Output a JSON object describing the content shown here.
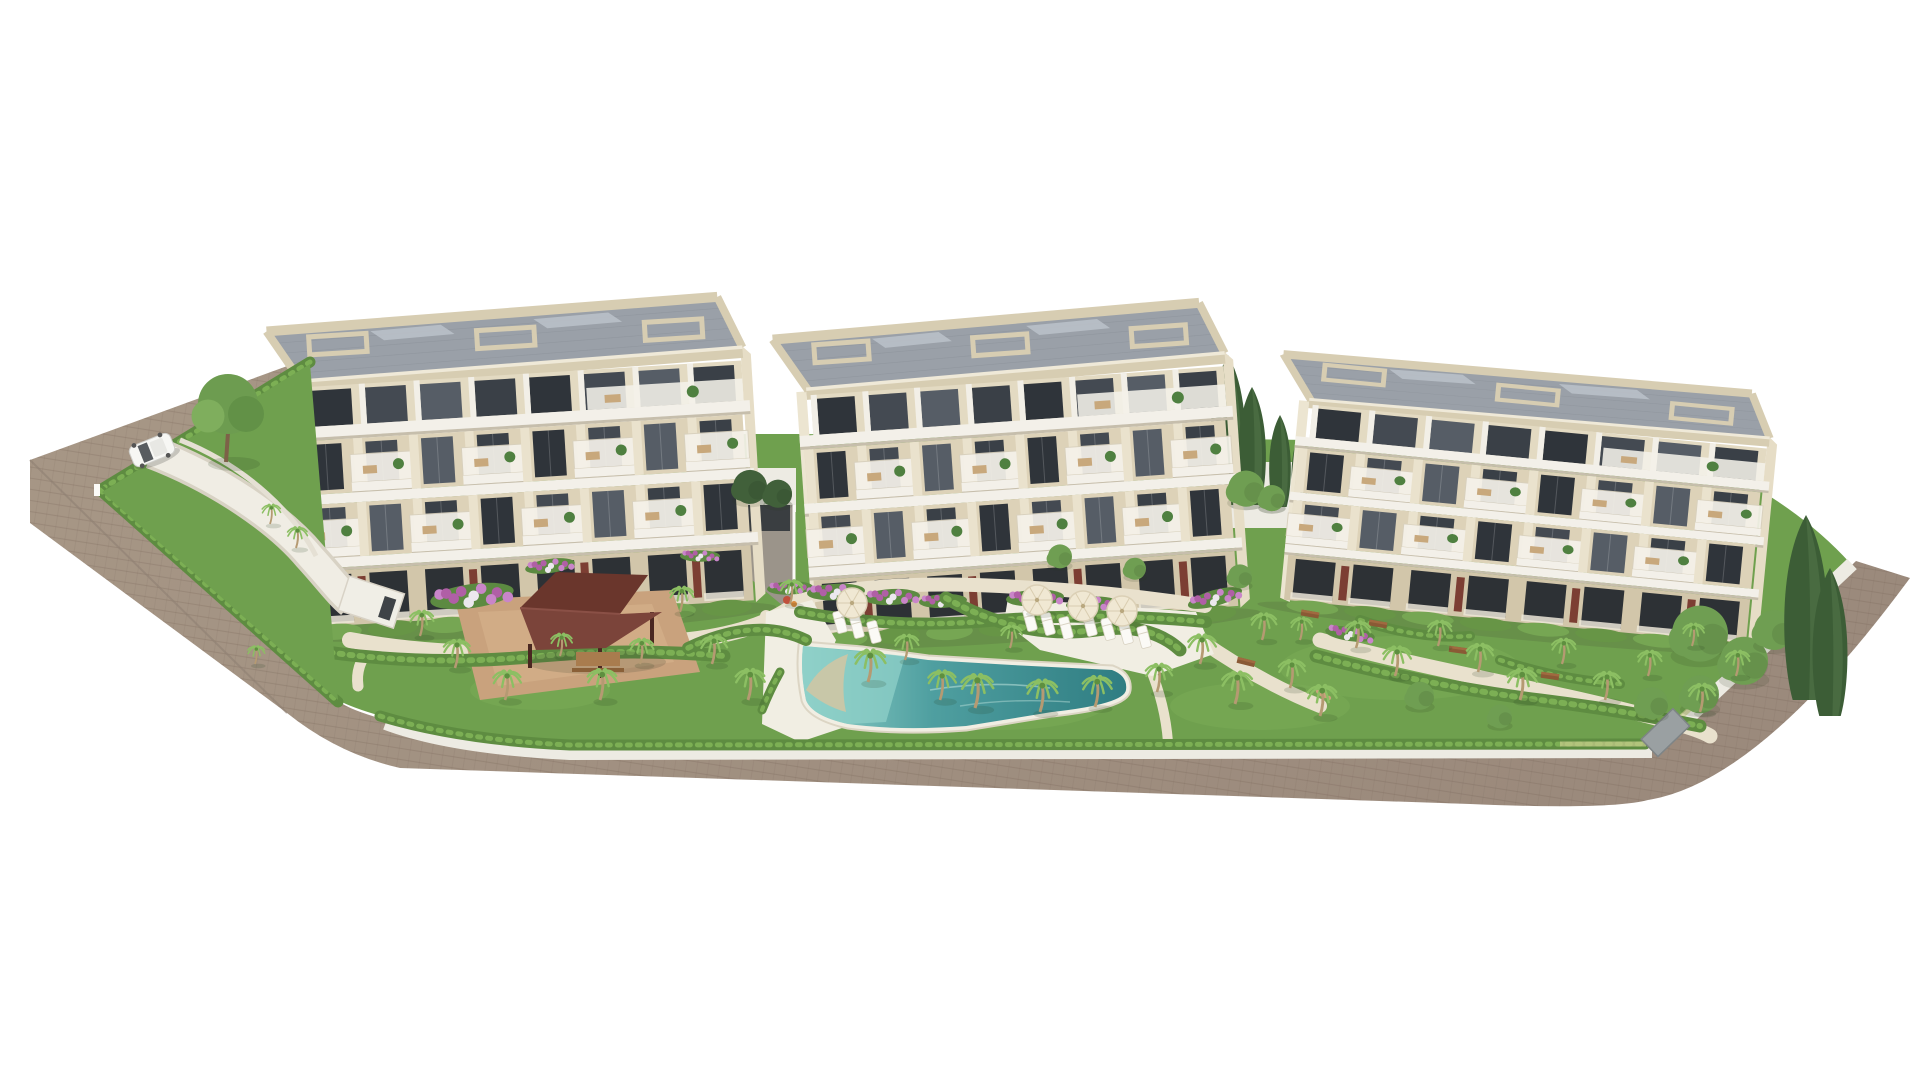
{
  "meta": {
    "description": "Aerial 3D architectural rendering of a residential complex: three cream low-rise apartment buildings with grey roof terraces and balconies, landscaped gardens with palm trees and hedges, a turquoise swimming pool with sun loungers and parasols, a dark-red wooden pergola, a white perimeter wall and a beige road wrapping the site, all on a plain white background. A single white car drives on the road at the upper left.",
    "canvas": {
      "width": 1920,
      "height": 1080
    }
  },
  "palette": {
    "background": "#ffffff",
    "road": "#a29184",
    "road_edge": "#8f8073",
    "curb": "#d9d3c6",
    "wall": "#edebe3",
    "lawn": "#6fa04e",
    "lawn_light": "#7cad58",
    "hedge": "#5e8c41",
    "hedge_light": "#7fb257",
    "palm_frond": "#8cbf63",
    "palm_trunk": "#b59a72",
    "cypress": "#3c5d36",
    "cypress_light": "#52754a",
    "shrub_light": "#6f9e52",
    "shrub_dark": "#41603a",
    "path": "#e9e1cd",
    "plaza": "#c9a27d",
    "plaza_light": "#d6b28c",
    "deck": "#f1eee3",
    "sand": "#d2c5a2",
    "pool_deep": "#2f7d82",
    "pool_mid": "#4f9fa0",
    "pool_light": "#8fd0c8",
    "facade": "#f2efe7",
    "facade_cream": "#ddd2b8",
    "facade_cream_dark": "#d2c6aa",
    "parapet": "#d7cdb2",
    "parapet_light": "#efe9d8",
    "slab": "#f3f0e9",
    "slab_shadow": "#c6beac",
    "roof_deck": "#9aa0a8",
    "roof_line": "#8a9098",
    "glass": [
      "#2f343a",
      "#444a52",
      "#565d66",
      "#3a4047"
    ],
    "red_panel": "#7c3e33",
    "pergola_dark": "#6a362c",
    "pergola_mid": "#7b443a",
    "furniture": "#c8a87c",
    "white": "#fbfaf6",
    "flower_pink": "#c985c9",
    "flower_magenta": "#b05fa6",
    "flower_white": "#ece8ee",
    "flower_red": "#c0503c",
    "bench_wood": "#8a5a35",
    "shadow": "rgba(60,65,50,0.16)"
  },
  "scene": {
    "buildings": [
      {
        "id": "apartment-building-1",
        "x": 290,
        "y": 322,
        "width": 442,
        "rotation": -3.5,
        "scale_y": 1,
        "floors": 4
      },
      {
        "id": "apartment-building-2",
        "x": 796,
        "y": 330,
        "width": 418,
        "rotation": -4,
        "scale_y": 1,
        "floors": 4
      },
      {
        "id": "apartment-building-3",
        "x": 1308,
        "y": 350,
        "width": 460,
        "rotation": 5.5,
        "scale_y": 0.82,
        "floors": 4
      }
    ],
    "car": {
      "x": 152,
      "y": 450,
      "rotation": -22,
      "color": "#f7f7f4"
    },
    "pergola": {
      "cx": 592,
      "cy": 624
    },
    "parasols": [
      {
        "x": 852,
        "y": 603
      },
      {
        "x": 1037,
        "y": 600
      },
      {
        "x": 1083,
        "y": 606
      },
      {
        "x": 1122,
        "y": 611
      }
    ],
    "loungers": [
      {
        "x": 840,
        "y": 622,
        "r": -15
      },
      {
        "x": 857,
        "y": 627,
        "r": -15
      },
      {
        "x": 874,
        "y": 632,
        "r": -15
      },
      {
        "x": 1030,
        "y": 620,
        "r": -15
      },
      {
        "x": 1048,
        "y": 624,
        "r": -15
      },
      {
        "x": 1066,
        "y": 628,
        "r": -15
      },
      {
        "x": 1090,
        "y": 625,
        "r": -15
      },
      {
        "x": 1108,
        "y": 629,
        "r": -15
      },
      {
        "x": 1126,
        "y": 633,
        "r": -15
      },
      {
        "x": 1144,
        "y": 637,
        "r": -15
      }
    ],
    "benches": [
      {
        "x": 1246,
        "y": 662,
        "r": 14
      },
      {
        "x": 1310,
        "y": 614,
        "r": 10
      },
      {
        "x": 1378,
        "y": 624,
        "r": 10
      },
      {
        "x": 1458,
        "y": 650,
        "r": 8
      },
      {
        "x": 1550,
        "y": 676,
        "r": 8
      }
    ],
    "flower_beds": [
      {
        "x": 472,
        "y": 596,
        "w": 84,
        "r": -8
      },
      {
        "x": 550,
        "y": 566,
        "w": 50,
        "r": -8
      },
      {
        "x": 700,
        "y": 556,
        "w": 40,
        "r": 0
      },
      {
        "x": 790,
        "y": 588,
        "w": 46,
        "r": -3
      },
      {
        "x": 836,
        "y": 592,
        "w": 58,
        "r": -3
      },
      {
        "x": 892,
        "y": 597,
        "w": 56,
        "r": -3
      },
      {
        "x": 943,
        "y": 601,
        "w": 48,
        "r": -3
      },
      {
        "x": 1035,
        "y": 598,
        "w": 58,
        "r": -3
      },
      {
        "x": 1092,
        "y": 604,
        "w": 52,
        "r": -3
      },
      {
        "x": 1215,
        "y": 598,
        "w": 56,
        "r": -16
      },
      {
        "x": 1350,
        "y": 634,
        "w": 50,
        "r": 8
      }
    ],
    "palms": [
      {
        "x": 420,
        "y": 636,
        "s": 0.9
      },
      {
        "x": 455,
        "y": 668,
        "s": 1.0
      },
      {
        "x": 505,
        "y": 700,
        "s": 1.05
      },
      {
        "x": 560,
        "y": 656,
        "s": 0.8
      },
      {
        "x": 600,
        "y": 700,
        "s": 1.1
      },
      {
        "x": 640,
        "y": 664,
        "s": 0.9
      },
      {
        "x": 270,
        "y": 524,
        "s": 0.7
      },
      {
        "x": 296,
        "y": 548,
        "s": 0.75
      },
      {
        "x": 255,
        "y": 664,
        "s": 0.65
      },
      {
        "x": 680,
        "y": 612,
        "s": 0.9
      },
      {
        "x": 712,
        "y": 664,
        "s": 1.0
      },
      {
        "x": 748,
        "y": 700,
        "s": 1.1
      },
      {
        "x": 790,
        "y": 604,
        "s": 0.85
      },
      {
        "x": 868,
        "y": 682,
        "s": 1.15
      },
      {
        "x": 905,
        "y": 660,
        "s": 0.9
      },
      {
        "x": 940,
        "y": 700,
        "s": 1.05
      },
      {
        "x": 975,
        "y": 708,
        "s": 1.2
      },
      {
        "x": 1010,
        "y": 648,
        "s": 0.8
      },
      {
        "x": 1040,
        "y": 712,
        "s": 1.15
      },
      {
        "x": 1095,
        "y": 707,
        "s": 1.1
      },
      {
        "x": 1157,
        "y": 692,
        "s": 1.0
      },
      {
        "x": 1200,
        "y": 664,
        "s": 1.05
      },
      {
        "x": 1235,
        "y": 704,
        "s": 1.15
      },
      {
        "x": 1262,
        "y": 640,
        "s": 0.95
      },
      {
        "x": 1290,
        "y": 688,
        "s": 1.0
      },
      {
        "x": 1300,
        "y": 640,
        "s": 0.8
      },
      {
        "x": 1320,
        "y": 716,
        "s": 1.1
      },
      {
        "x": 1356,
        "y": 648,
        "s": 0.95
      },
      {
        "x": 1395,
        "y": 676,
        "s": 1.05
      },
      {
        "x": 1438,
        "y": 646,
        "s": 0.9
      },
      {
        "x": 1478,
        "y": 672,
        "s": 1.0
      },
      {
        "x": 1520,
        "y": 700,
        "s": 1.1
      },
      {
        "x": 1562,
        "y": 664,
        "s": 0.9
      },
      {
        "x": 1605,
        "y": 700,
        "s": 1.0
      },
      {
        "x": 1648,
        "y": 676,
        "s": 0.9
      },
      {
        "x": 1700,
        "y": 712,
        "s": 1.0
      },
      {
        "x": 1736,
        "y": 676,
        "s": 0.9
      },
      {
        "x": 1692,
        "y": 646,
        "s": 0.8
      }
    ],
    "cypresses": [
      {
        "x": 1228,
        "y": 505,
        "h": 150
      },
      {
        "x": 1252,
        "y": 505,
        "h": 118
      },
      {
        "x": 1280,
        "y": 507,
        "h": 92
      },
      {
        "x": 1300,
        "y": 505,
        "h": 72
      },
      {
        "x": 1806,
        "y": 700,
        "h": 185
      },
      {
        "x": 1830,
        "y": 716,
        "h": 148
      }
    ],
    "shrubs": [
      {
        "x": 750,
        "y": 492,
        "r": 17,
        "tone": "dark"
      },
      {
        "x": 778,
        "y": 498,
        "r": 14,
        "tone": "dark"
      },
      {
        "x": 1246,
        "y": 494,
        "r": 18,
        "tone": "light"
      },
      {
        "x": 1272,
        "y": 502,
        "r": 13,
        "tone": "light"
      },
      {
        "x": 1700,
        "y": 642,
        "r": 28,
        "tone": "light"
      },
      {
        "x": 1744,
        "y": 668,
        "r": 24,
        "tone": "light"
      },
      {
        "x": 1774,
        "y": 636,
        "r": 20,
        "tone": "light"
      },
      {
        "x": 1700,
        "y": 700,
        "r": 19,
        "tone": "light"
      },
      {
        "x": 1652,
        "y": 708,
        "r": 16,
        "tone": "light"
      },
      {
        "x": 1806,
        "y": 658,
        "r": 15,
        "tone": "dark"
      },
      {
        "x": 1060,
        "y": 560,
        "r": 12,
        "tone": "light"
      },
      {
        "x": 1135,
        "y": 572,
        "r": 11,
        "tone": "light"
      },
      {
        "x": 1240,
        "y": 580,
        "r": 12,
        "tone": "light"
      },
      {
        "x": 1420,
        "y": 700,
        "r": 14,
        "tone": "light"
      },
      {
        "x": 1500,
        "y": 720,
        "r": 12,
        "tone": "light"
      }
    ],
    "trees": [
      {
        "x": 226,
        "y": 452,
        "r": 30
      }
    ],
    "person": {
      "x": 1322,
      "y": 694
    }
  }
}
